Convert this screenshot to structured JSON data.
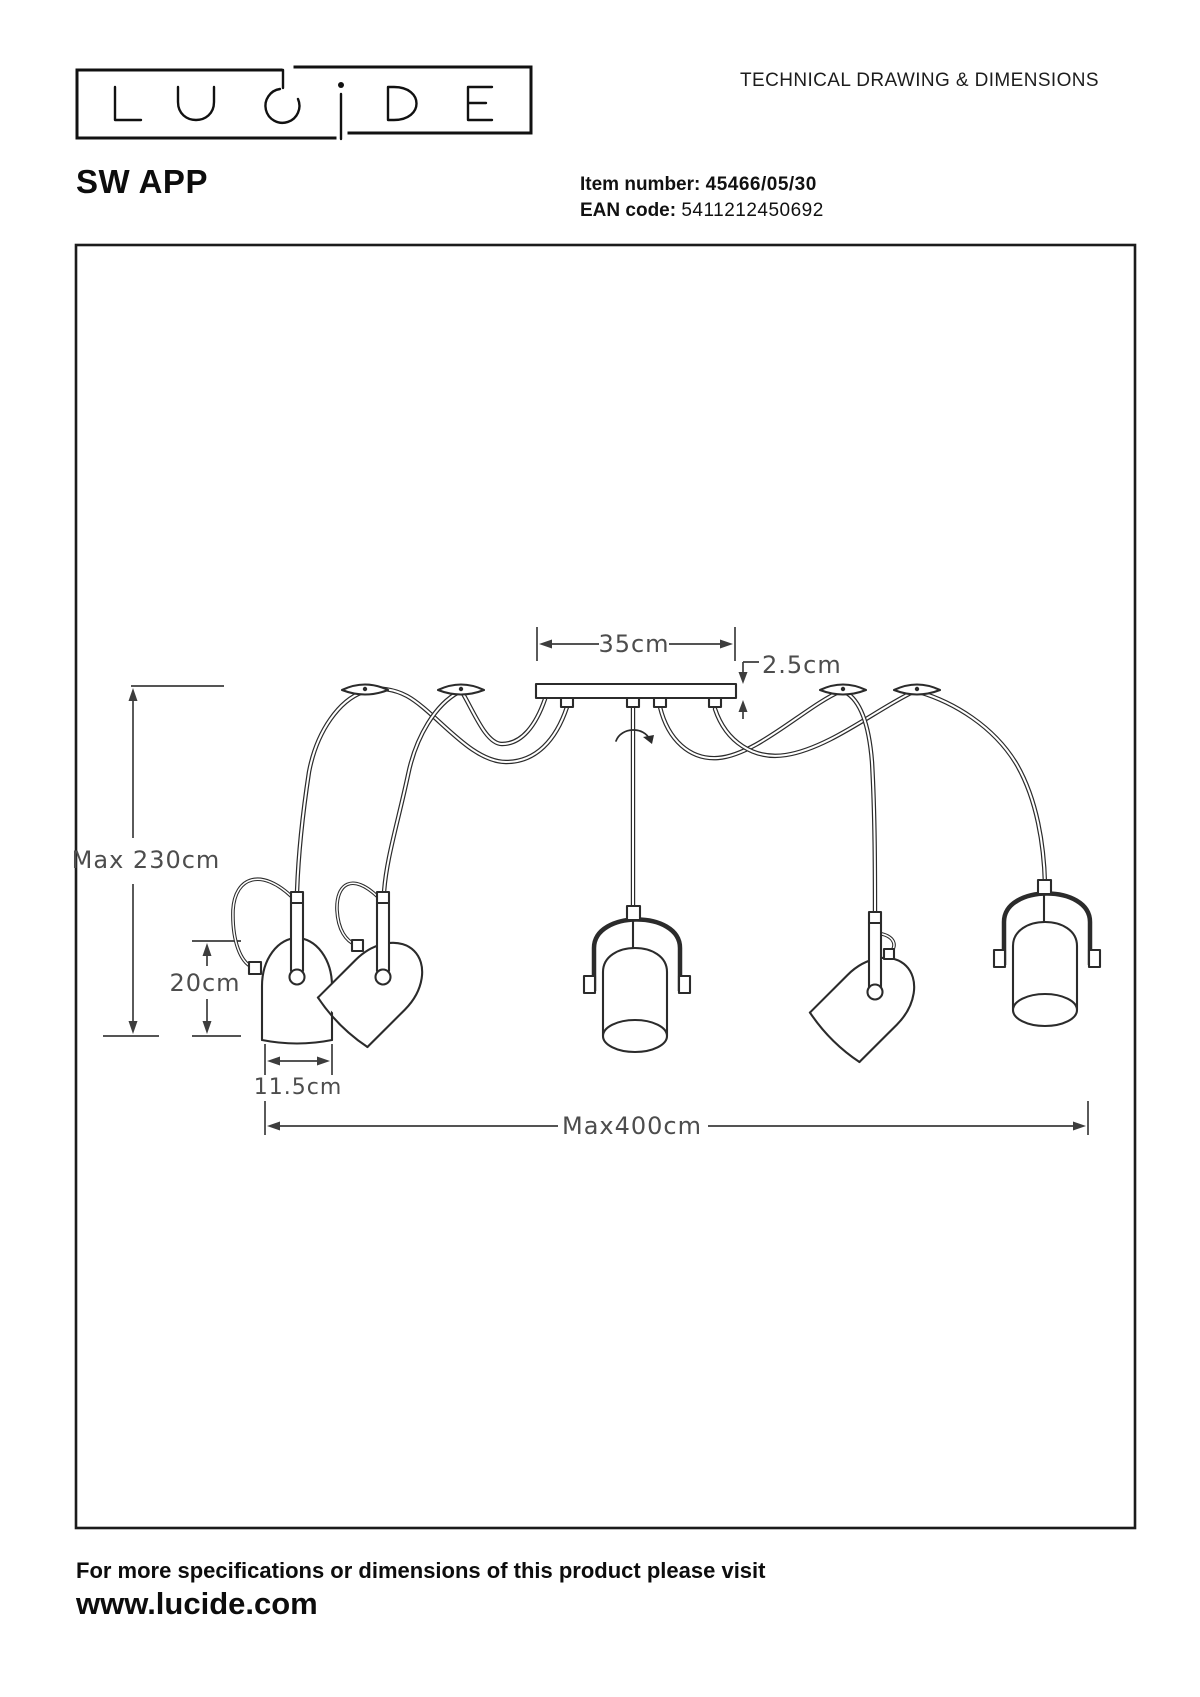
{
  "header": {
    "title": "TECHNICAL DRAWING & DIMENSIONS",
    "brand": "LUCIDE",
    "product_name": "SW APP",
    "item_label": "Item number:",
    "item_value": "45466/05/30",
    "ean_label": "EAN code:",
    "ean_value": "5411212450692"
  },
  "drawing": {
    "dim_plate_width": "35cm",
    "dim_plate_height": "2.5cm",
    "dim_max_height": "Max 230cm",
    "dim_lamp_height": "20cm",
    "dim_lamp_width": "11.5cm",
    "dim_max_width": "Max400cm"
  },
  "footer": {
    "line1": "For more specifications or dimensions of this product please visit",
    "line2": "www.lucide.com"
  },
  "colors": {
    "line": "#2b2b2b",
    "dim_text": "#4d4d4d",
    "background": "#ffffff"
  }
}
